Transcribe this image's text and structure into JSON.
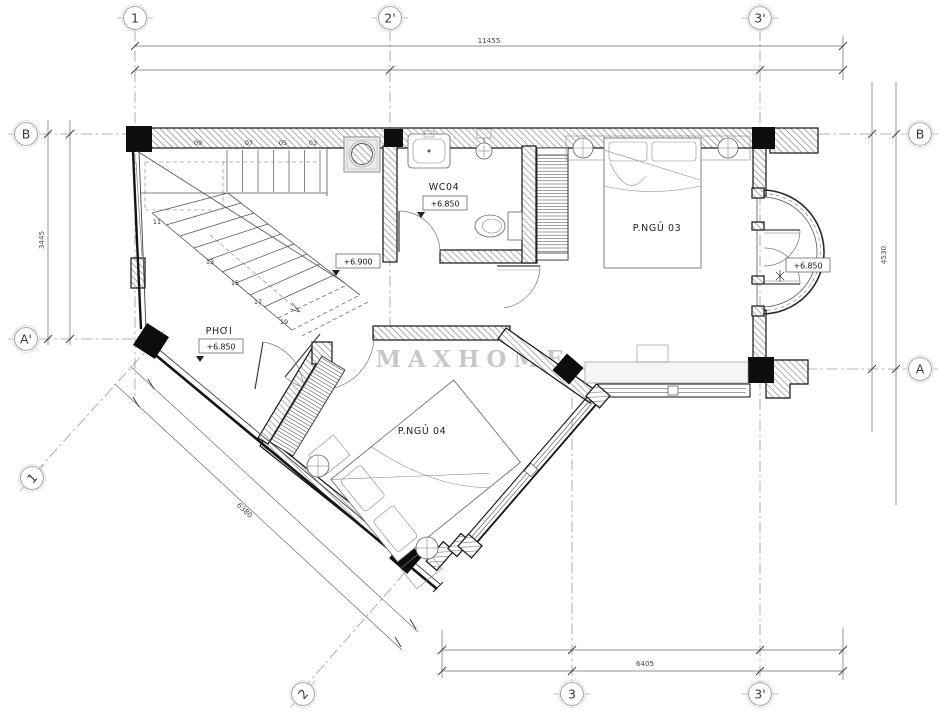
{
  "watermark": "MAXHOME",
  "axes": {
    "top": [
      "1",
      "2'",
      "3'"
    ],
    "bottom": [
      "2",
      "3",
      "3'"
    ],
    "left": [
      "B",
      "A'"
    ],
    "right": [
      "B",
      "A"
    ],
    "diag": "1"
  },
  "dims": {
    "total_width": "11455",
    "left_height": "3445",
    "right_height": "4530",
    "bottom_width": "6405",
    "diagonal": "6380"
  },
  "rooms": {
    "wc04": {
      "label": "WC04",
      "level": "+6.850"
    },
    "hall": {
      "level": "+6.900"
    },
    "phoi": {
      "label": "PHƠI",
      "level": "+6.850"
    },
    "bedroom3": {
      "label": "P.NGỦ 03"
    },
    "bedroom4": {
      "label": "P.NGỦ 04"
    },
    "balcony": {
      "level": "+6.850"
    }
  },
  "stairs": {
    "steps": [
      "03",
      "05",
      "07",
      "09",
      "11",
      "13",
      "15",
      "17",
      "19"
    ]
  },
  "colors": {
    "wall_line": "#141414",
    "watermark": "#c8c8c8",
    "axis_line": "#9a9a9a"
  }
}
